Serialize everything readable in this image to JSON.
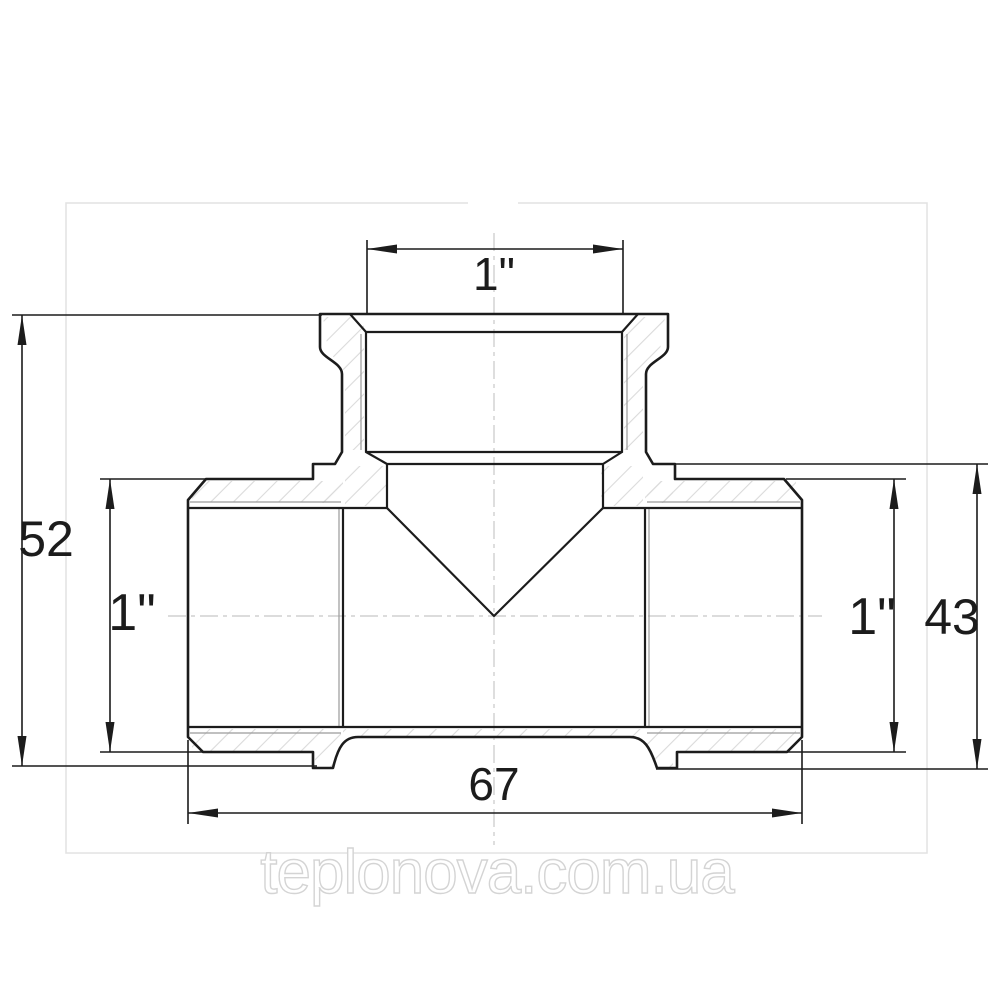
{
  "page": {
    "width": 1000,
    "height": 1000,
    "background": "#ffffff"
  },
  "frame": {
    "color": "#e2e2e2"
  },
  "drawing": {
    "subject": "threaded-tee-fitting-cross-section",
    "line_color": "#1c1c1c",
    "thin_line_color": "#9a9a9a",
    "centerline_color": "#c8c8c8",
    "hatch_color": "#dadada",
    "dimensions": {
      "top_branch": "1\"",
      "overall_height": "52",
      "left_port": "1\"",
      "right_port": "1\"",
      "body_height": "43",
      "overall_width": "67"
    }
  },
  "watermark": {
    "text": "teplonova.com.ua",
    "outline_color": "#d4d4d4"
  }
}
